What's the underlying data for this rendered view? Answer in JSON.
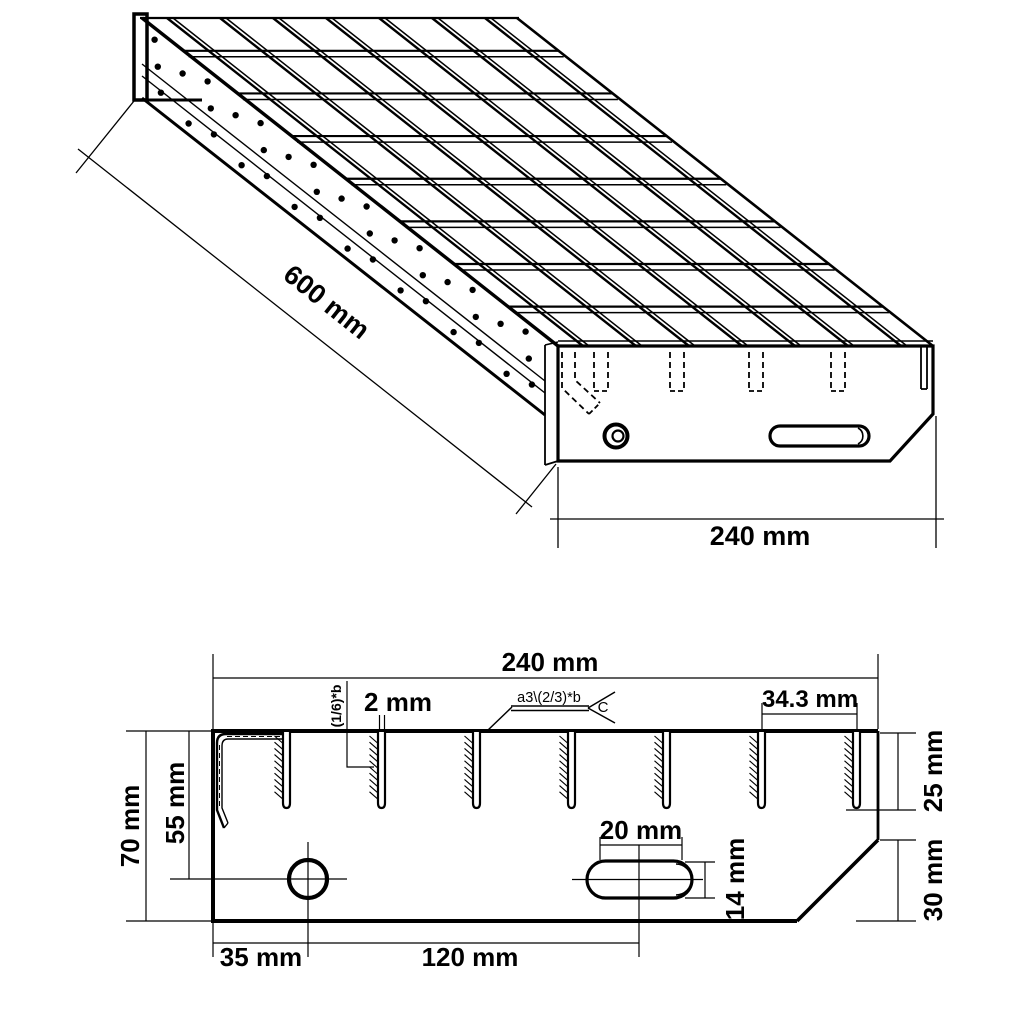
{
  "figure_type": "technical-drawing-grating-stair-tread",
  "colors": {
    "background": "#ffffff",
    "line": "#000000"
  },
  "iso": {
    "length_label": "600 mm",
    "end_width_label": "240 mm"
  },
  "profile": {
    "width_label": "240 mm",
    "bar_thickness_label": "2 mm",
    "weld_throat_note": "(1/6)*b",
    "weld_spec_note": "a3\\(2/3)*b",
    "weld_tail_letter": "C",
    "bar_pitch_label": "34.3 mm",
    "plate_height_label": "70 mm",
    "hole_offset_top_label": "55 mm",
    "slot_depth_label": "25 mm",
    "bevel_height_label": "30 mm",
    "slot_length_label": "20 mm",
    "slot_width_label": "14 mm",
    "hole_offset_left_label": "35 mm",
    "hole_to_slot_label": "120 mm"
  }
}
